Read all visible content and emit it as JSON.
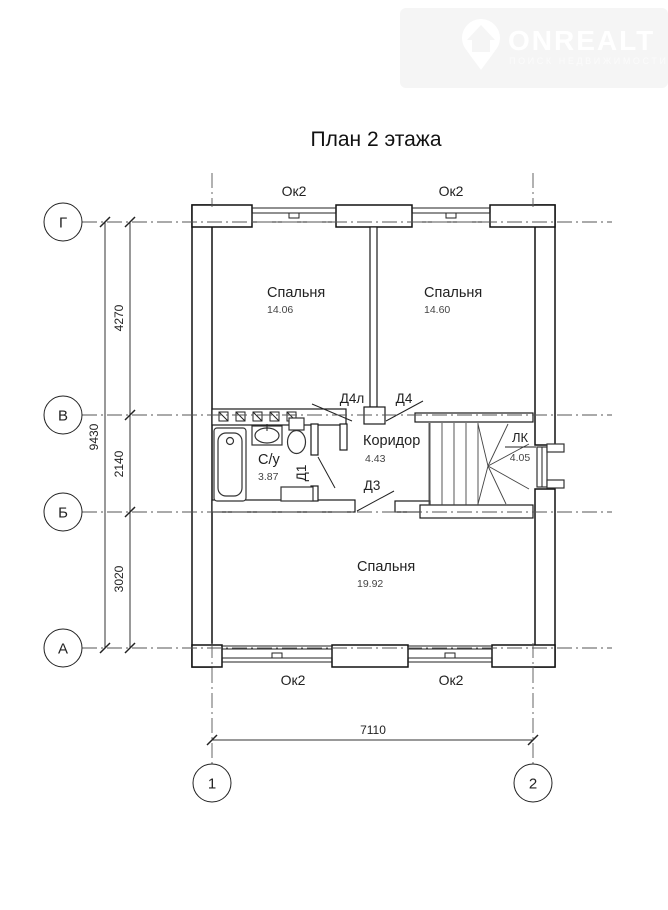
{
  "watermark": {
    "brand": "ONREALT",
    "tagline": "ПОИСК НЕДВИЖИМОСТИ"
  },
  "title": "План 2 этажа",
  "grid_axes": {
    "rows": [
      {
        "label": "Г"
      },
      {
        "label": "В"
      },
      {
        "label": "Б"
      },
      {
        "label": "А"
      }
    ],
    "cols": [
      {
        "label": "1"
      },
      {
        "label": "2"
      }
    ]
  },
  "dimensions": {
    "total_vertical": "9430",
    "segments_vertical": [
      {
        "value": "4270"
      },
      {
        "value": "2140"
      },
      {
        "value": "3020"
      }
    ],
    "total_horizontal": "7110"
  },
  "rooms": {
    "bedroom1": {
      "name": "Спальня",
      "area": "14.06"
    },
    "bedroom2": {
      "name": "Спальня",
      "area": "14.60"
    },
    "bedroom3": {
      "name": "Спальня",
      "area": "19.92"
    },
    "bathroom": {
      "name": "С/у",
      "area": "3.87"
    },
    "corridor": {
      "name": "Коридор",
      "area": "4.43"
    },
    "stairs": {
      "name": "ЛК",
      "area": "4.05"
    }
  },
  "windows": {
    "top_left": "Ок2",
    "top_right": "Ок2",
    "bottom_left": "Ок2",
    "bottom_right": "Ок2"
  },
  "doors": {
    "d4l": "Д4л",
    "d4": "Д4",
    "d3": "Д3",
    "d1": "Д1"
  }
}
